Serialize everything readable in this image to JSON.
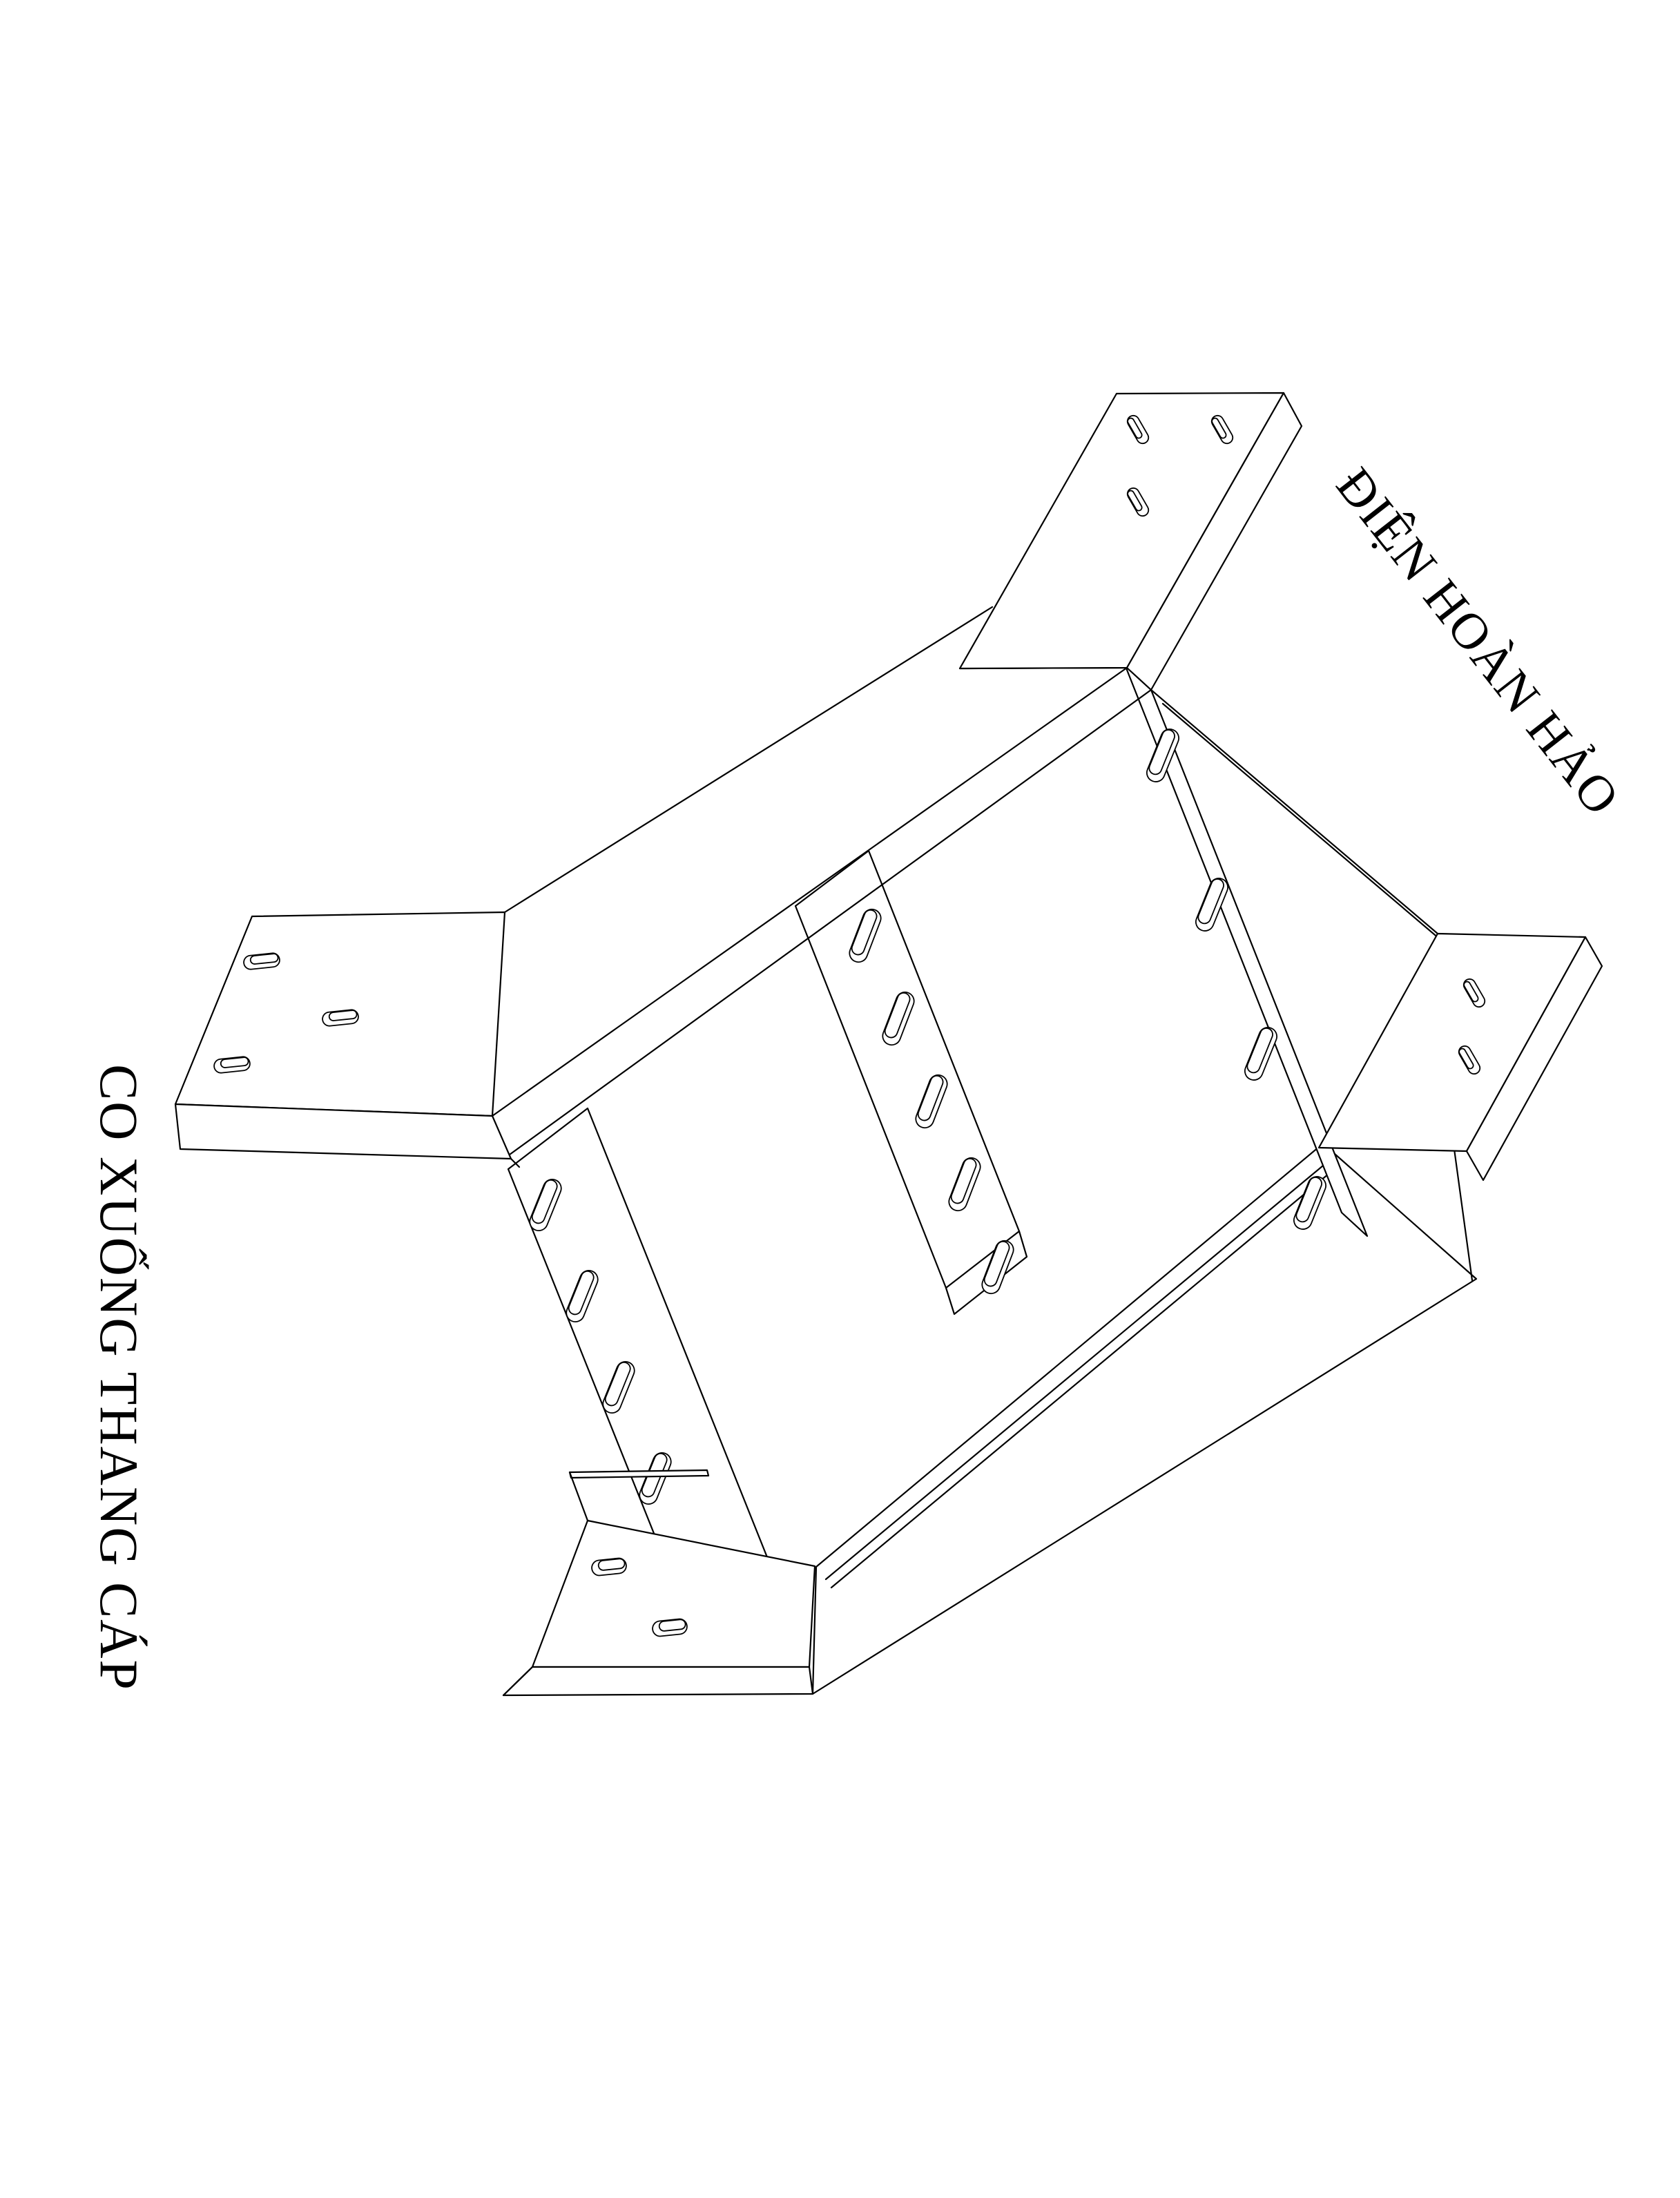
{
  "page": {
    "background": "#ffffff",
    "line_color": "#000000"
  },
  "labels": {
    "brand": "ĐIỆN HOÀN HẢO",
    "product": "CO XUỐNG THANG CÁP"
  },
  "drawing": {
    "title": "CO XUỐNG THANG CÁP",
    "type": "isometric-cad-line-drawing",
    "subject": "cable-ladder-down-elbow",
    "parts": [
      "left-end-flange-plate",
      "upper-run-side-wall",
      "upper-end-connection-flange",
      "near-joint-rail",
      "middle-joint-rail",
      "far-joint-rail",
      "lower-run-channel",
      "bottom-flange-plate",
      "lower-end-connection-flange"
    ],
    "slot_counts": {
      "left_flange": 3,
      "upper_flange": 3,
      "near_rail": 5,
      "middle_rail": 5,
      "far_rail": 4,
      "bottom_flange": 2,
      "lower_flange": 2
    }
  }
}
